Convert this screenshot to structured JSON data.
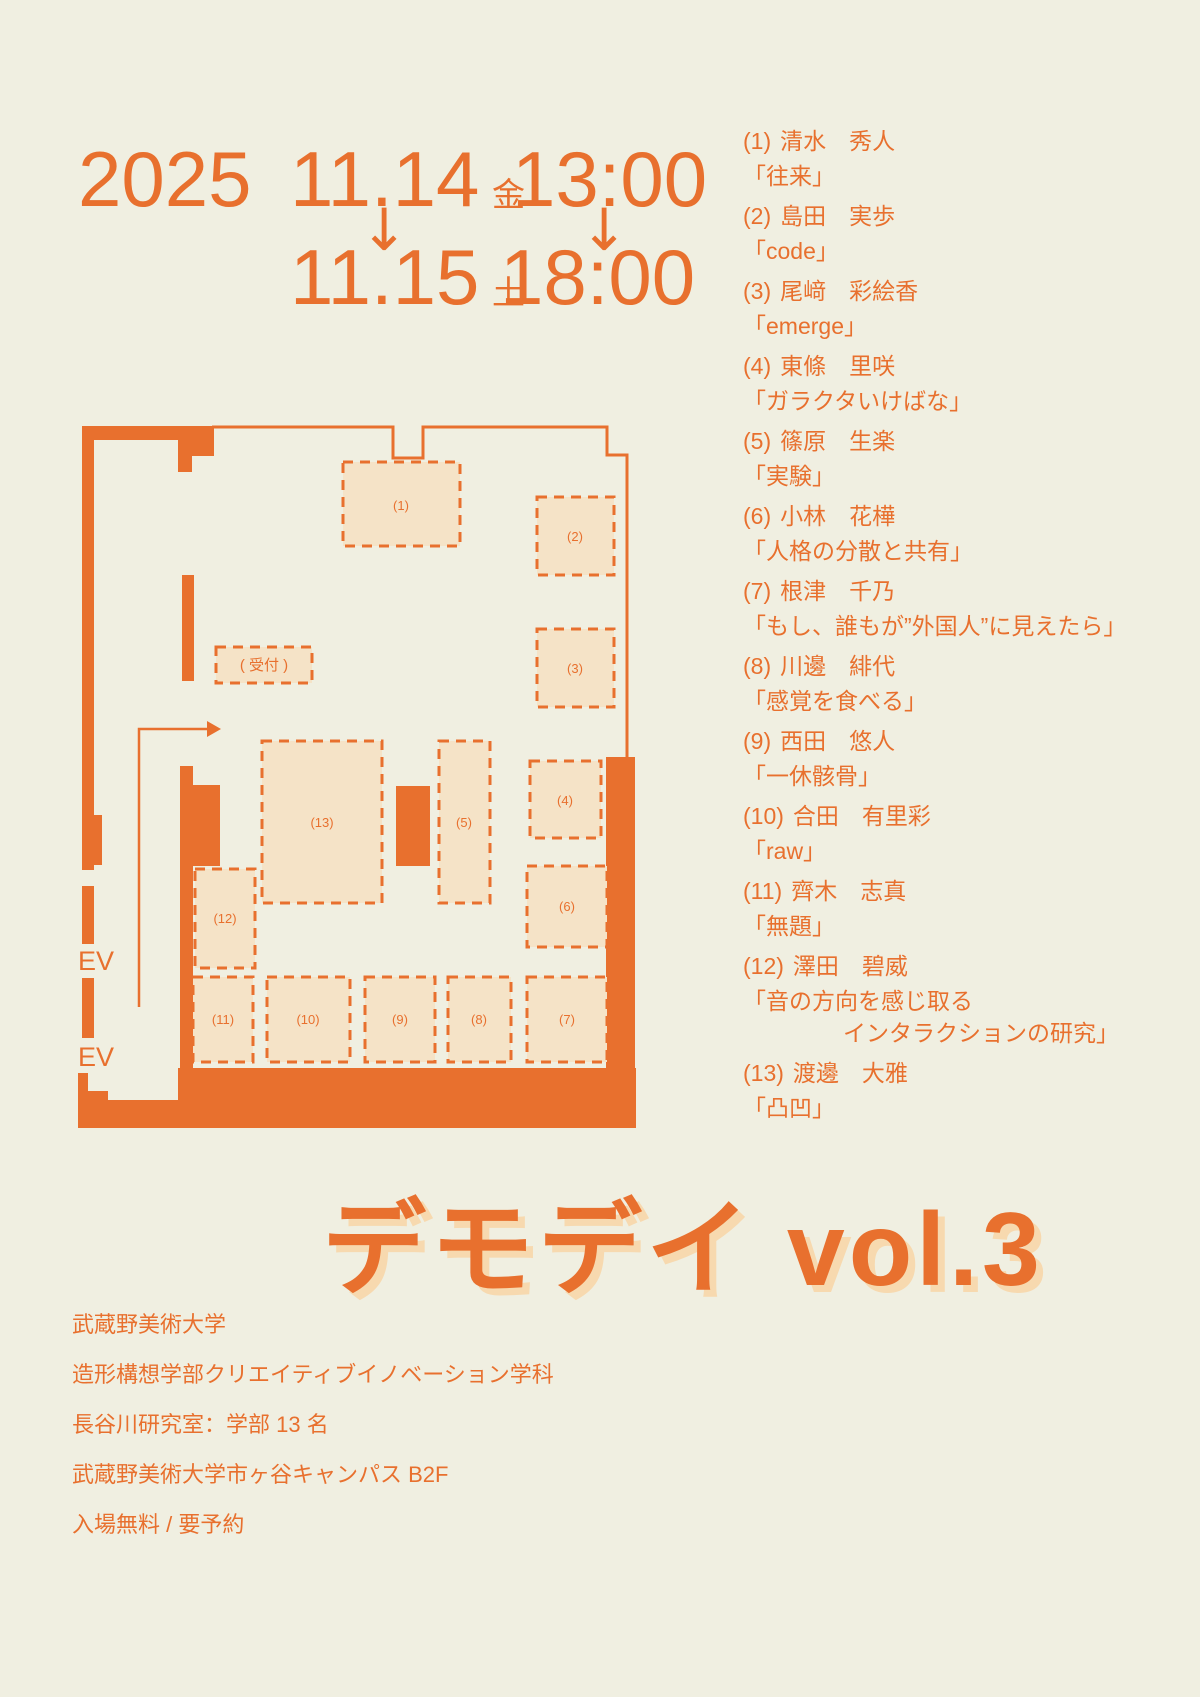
{
  "page": {
    "accent": "#E8702E",
    "background": "#F0EFE1",
    "booth_fill": "#F5E3C7",
    "title_shadow": "#F7D9AF"
  },
  "header": {
    "year": "2025",
    "date_from": "11.14",
    "day_from": "金",
    "time_from": "13:00",
    "date_to": "11.15",
    "day_to": "土",
    "time_to": "18:00",
    "arrow": "↓"
  },
  "floorplan": {
    "reception_label": "( 受付 )",
    "ev_label": "EV",
    "booths": [
      "(1)",
      "(2)",
      "(3)",
      "(4)",
      "(5)",
      "(6)",
      "(7)",
      "(8)",
      "(9)",
      "(10)",
      "(11)",
      "(12)",
      "(13)"
    ]
  },
  "exhibitors": [
    {
      "no": "(1)",
      "name": "清水　秀人",
      "title": "「往来」"
    },
    {
      "no": "(2)",
      "name": "島田　実歩",
      "title": "「code」"
    },
    {
      "no": "(3)",
      "name": "尾﨑　彩絵香",
      "title": "「emerge」"
    },
    {
      "no": "(4)",
      "name": "東條　里咲",
      "title": "「ガラクタいけばな」"
    },
    {
      "no": "(5)",
      "name": "篠原　生楽",
      "title": "「実験」"
    },
    {
      "no": "(6)",
      "name": "小林　花樺",
      "title": "「人格の分散と共有」"
    },
    {
      "no": "(7)",
      "name": "根津　千乃",
      "title": "「もし、誰もが”外国人”に見えたら」"
    },
    {
      "no": "(8)",
      "name": "川邊　緋代",
      "title": "「感覚を食べる」"
    },
    {
      "no": "(9)",
      "name": "西田　悠人",
      "title": "「一休骸骨」"
    },
    {
      "no": "(10)",
      "name": "合田　有里彩",
      "title": "「raw」"
    },
    {
      "no": "(11)",
      "name": "齊木　志真",
      "title": "「無題」"
    },
    {
      "no": "(12)",
      "name": "澤田　碧威",
      "title": "「音の方向を感じ取る",
      "title2": "インタラクションの研究」"
    },
    {
      "no": "(13)",
      "name": "渡邊　大雅",
      "title": "「凸凹」"
    }
  ],
  "title": "デモデイ vol.3",
  "footer": {
    "lines": [
      "武蔵野美術大学",
      "造形構想学部クリエイティブイノベーション学科",
      "長谷川研究室：学部 13 名",
      "武蔵野美術大学市ヶ谷キャンパス B2F",
      "入場無料 / 要予約"
    ]
  }
}
